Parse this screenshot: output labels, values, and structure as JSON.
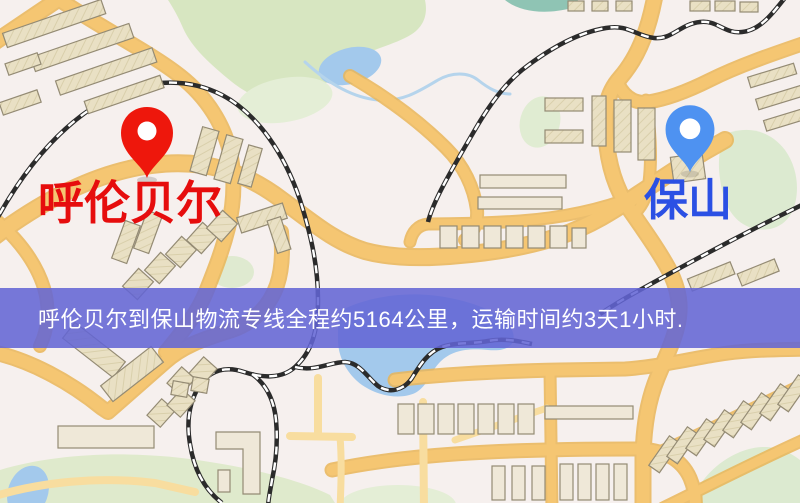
{
  "map": {
    "markers": {
      "origin": {
        "name": "呼伦贝尔",
        "pin_color": "#ee170c",
        "label_color": "#e60d0d",
        "pin_style": "red teardrop pin with white hole"
      },
      "destination": {
        "name": "保山",
        "pin_color": "#4e92f1",
        "label_color": "#2b50e4",
        "pin_style": "blue teardrop pin with white hole"
      }
    },
    "palette": {
      "background": "#f6f0ee",
      "road": "#f5c672",
      "road_minor": "#f8dd9f",
      "railway": "#2b2b2b",
      "park": "#d7e6c1",
      "water": "#a3c9ec",
      "building": "#e9e0c4"
    }
  },
  "banner": {
    "text": "呼伦贝尔到保山物流专线全程约5164公里，运输时间约3天1小时.",
    "origin": "呼伦贝尔",
    "destination": "保山",
    "distance_km": "5164",
    "transit_time": "3天1小时",
    "background_color": "#6365d4",
    "text_color": "#ffffff"
  }
}
